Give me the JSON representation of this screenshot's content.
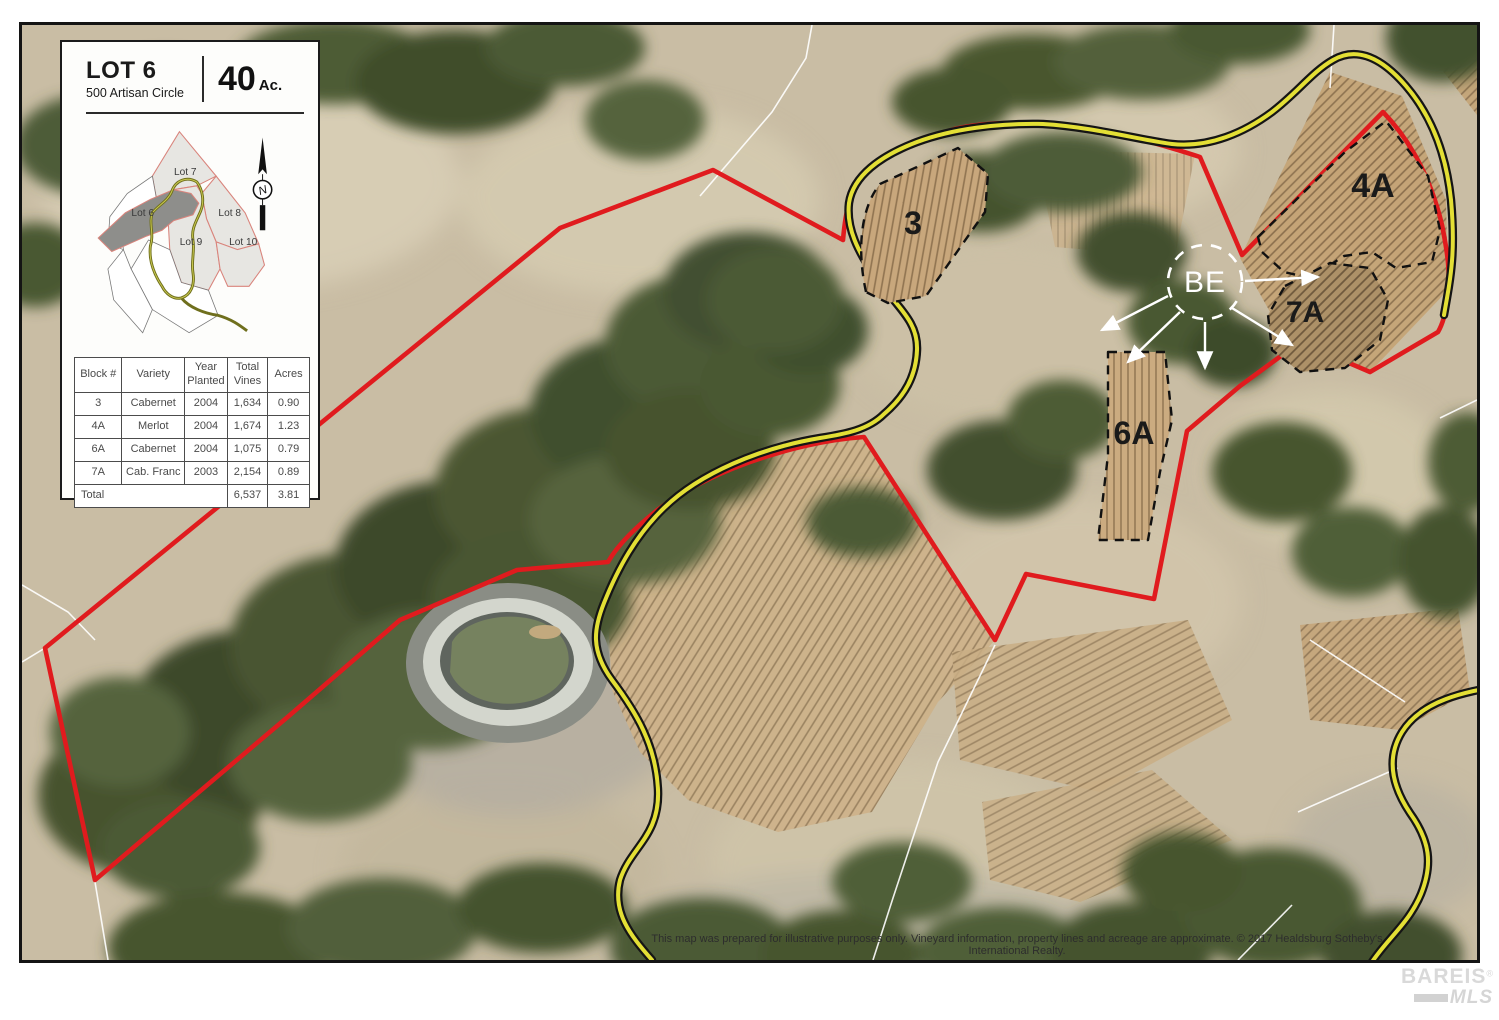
{
  "panel": {
    "lot_title": "LOT 6",
    "address": "500 Artisan Circle",
    "acres_value": "40",
    "acres_unit": "Ac.",
    "inset": {
      "lot6": "Lot 6",
      "lot7": "Lot 7",
      "lot8": "Lot 8",
      "lot9": "Lot 9",
      "lot10": "Lot 10",
      "north": "N"
    }
  },
  "table": {
    "headers": {
      "block": [
        "Block #"
      ],
      "variety": [
        "Variety"
      ],
      "year": [
        "Year",
        "Planted"
      ],
      "vines": [
        "Total",
        "Vines"
      ],
      "acres": [
        "Acres"
      ]
    },
    "rows": [
      [
        "3",
        "Cabernet",
        "2004",
        "1,634",
        "0.90"
      ],
      [
        "4A",
        "Merlot",
        "2004",
        "1,674",
        "1.23"
      ],
      [
        "6A",
        "Cabernet",
        "2004",
        "1,075",
        "0.79"
      ],
      [
        "7A",
        "Cab. Franc",
        "2003",
        "2,154",
        "0.89"
      ]
    ],
    "total_label": "Total",
    "total_vines": "6,537",
    "total_acres": "3.81"
  },
  "map": {
    "labels": {
      "block3": "3",
      "block4a": "4A",
      "block6a": "6A",
      "block7a": "7A",
      "be": "BE"
    },
    "disclaimer": "This map was prepared for illustrative purposes only. Vineyard information, property lines and acreage are approximate. © 2017 Healdsburg Sotheby's International Realty.",
    "colors": {
      "boundary": "#e01b1e",
      "road_fill": "#e3df35",
      "road_casing": "#151515",
      "water": "#76825f",
      "terrain": "#c9bda4"
    }
  },
  "logo": {
    "brand": "BAREIS",
    "reg": "®",
    "sub": "MLS"
  }
}
